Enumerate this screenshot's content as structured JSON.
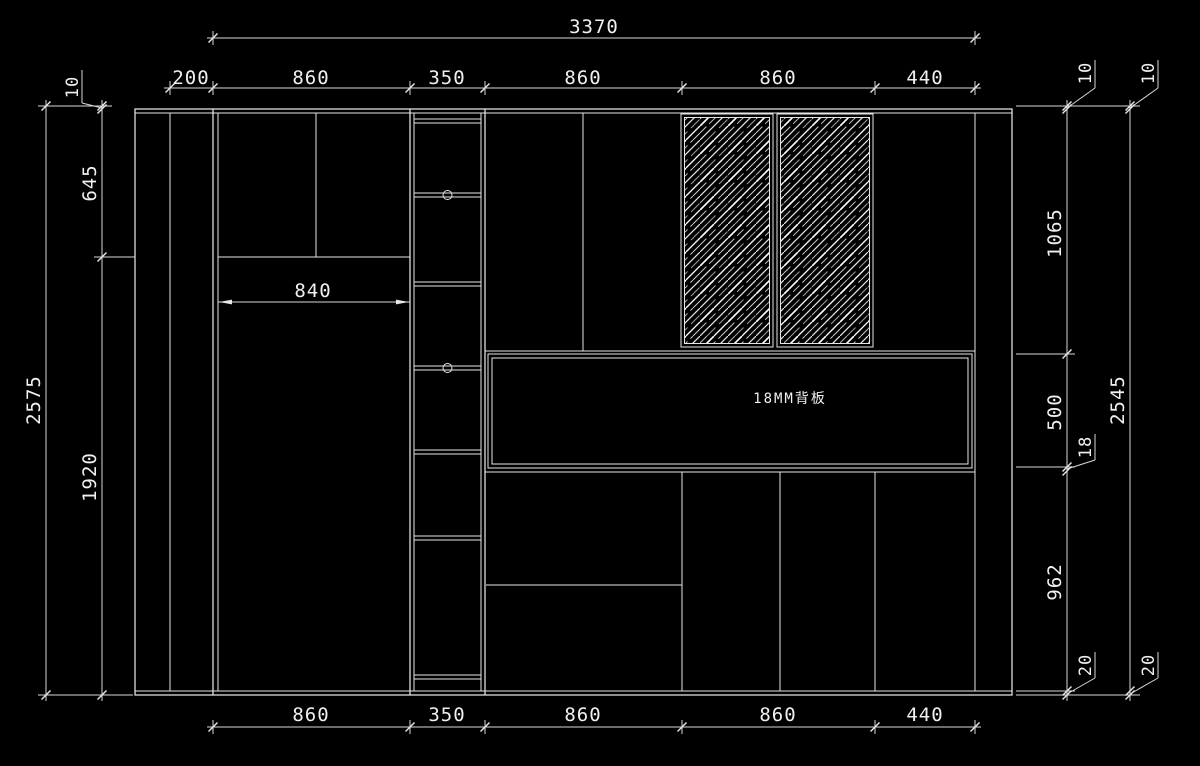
{
  "drawing": {
    "back_panel_label": "18MM背板",
    "interior_width": "840"
  },
  "dims": {
    "h_total": "3370",
    "h_row": [
      "200",
      "860",
      "350",
      "860",
      "860",
      "440"
    ],
    "h_bottom": [
      "860",
      "350",
      "860",
      "860",
      "440"
    ],
    "v_left_total": "2575",
    "v_left": [
      "10",
      "645",
      "1920"
    ],
    "v_right_inner": [
      "10",
      "1065",
      "500",
      "18",
      "962",
      "20"
    ],
    "v_right_outer": [
      "10",
      "2545",
      "20"
    ]
  },
  "colors": {
    "background": "#000000",
    "line": "#e6e6e6",
    "dim_line": "#d9d9d9",
    "text": "#f0f0f0"
  }
}
